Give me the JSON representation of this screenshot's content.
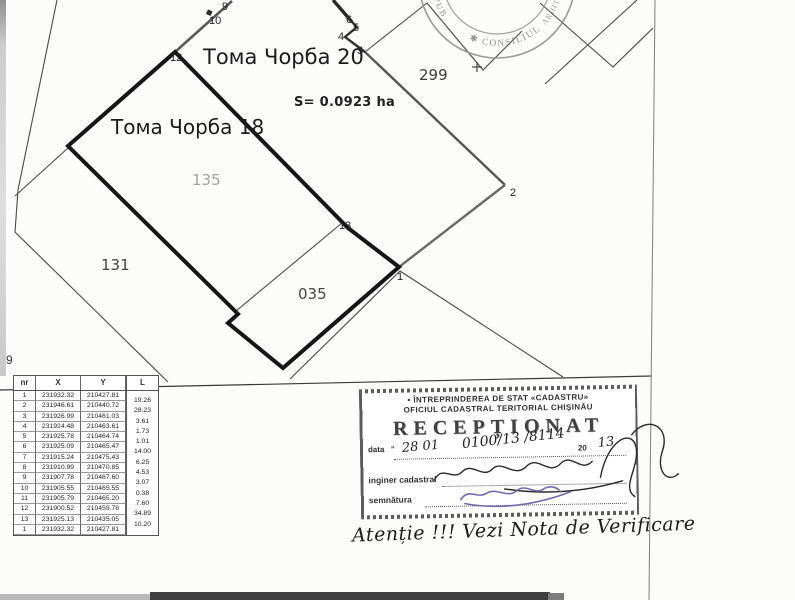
{
  "map": {
    "street_label_20": "Тома Чорба 20",
    "street_label_18": "Тома Чорба 18",
    "area_label": "S= 0.0923 ha",
    "parcel_299": "299",
    "parcel_135": "135",
    "parcel_131": "131",
    "parcel_035": "035",
    "points": [
      "9",
      "10",
      "12",
      "6",
      "5",
      "4",
      "3",
      "2",
      "13",
      "1"
    ],
    "margin_point": "9"
  },
  "coords_table": {
    "headers": [
      "nr",
      "X",
      "Y",
      "L"
    ],
    "rows": [
      {
        "nr": "1",
        "x": "231932.32",
        "y": "210427.81"
      },
      {
        "nr": "2",
        "x": "231946.61",
        "y": "210440.72"
      },
      {
        "nr": "3",
        "x": "231926.99",
        "y": "210461.03"
      },
      {
        "nr": "4",
        "x": "231924.48",
        "y": "210463.61"
      },
      {
        "nr": "5",
        "x": "231925.78",
        "y": "210464.74"
      },
      {
        "nr": "6",
        "x": "231925.09",
        "y": "210465.47"
      },
      {
        "nr": "7",
        "x": "231915.24",
        "y": "210475.43"
      },
      {
        "nr": "8",
        "x": "231910.99",
        "y": "210470.85"
      },
      {
        "nr": "9",
        "x": "231907.78",
        "y": "210467.60"
      },
      {
        "nr": "10",
        "x": "231905.55",
        "y": "210465.55"
      },
      {
        "nr": "11",
        "x": "231905.79",
        "y": "210465.20"
      },
      {
        "nr": "12",
        "x": "231900.52",
        "y": "210459.78"
      },
      {
        "nr": "13",
        "x": "231925.13",
        "y": "210435.05"
      },
      {
        "nr": "1",
        "x": "231932.32",
        "y": "210427.81"
      }
    ],
    "lengths": [
      "19.26",
      "28.23",
      "3.61",
      "1.73",
      "1.01",
      "14.00",
      "6.25",
      "4.53",
      "3.07",
      "0.38",
      "7.60",
      "34.89",
      "10.20"
    ]
  },
  "stamp": {
    "org_line1": "• ÎNTREPRINDEREA DE STAT «CADASTRU»",
    "org_line2": "OFICIUL CADASTRAL TERITORIAL CHIȘINĂU",
    "title": "RECEPȚIONAT",
    "date_label": "data",
    "date_quote": "\"",
    "date_value": "28 01",
    "reg_value": "0100/13 /8114",
    "year_prefix": "20",
    "year_value": "13",
    "engineer_label": "inginer cadastral",
    "signature_label": "semnătura"
  },
  "seal": {
    "left_text": "REPUB",
    "bottom_text": "✱ CONSILIUL",
    "right_text": "ARHITECT"
  },
  "note_text": "Atenție !!! Vezi Nota de Verificare"
}
